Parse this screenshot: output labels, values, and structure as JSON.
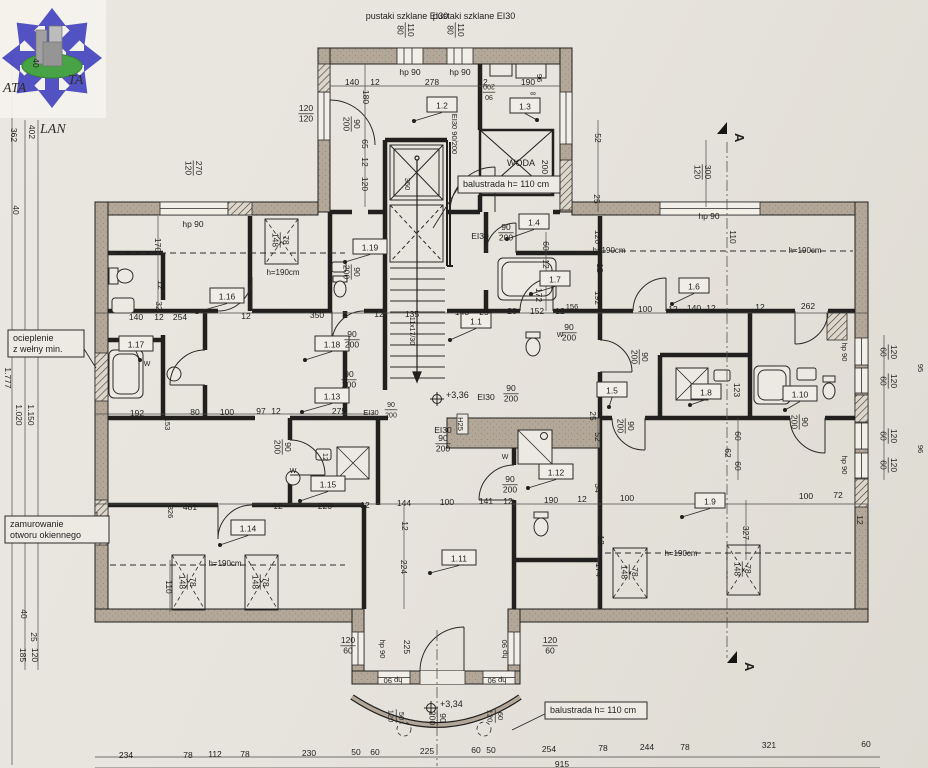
{
  "logo": {
    "ata": "ATA",
    "ta": "TA",
    "lan": "LAN",
    "blue": "#4646c0",
    "green": "#3a9e3a",
    "building": "#9b9b9b"
  },
  "annotations": {
    "glass_blocks_1": "pustaki szklane EI30",
    "glass_blocks_2": "pustaki szklane EI30",
    "water_shaft": "WODA"
  },
  "levels": [
    {
      "t": "+3,36",
      "x": 437,
      "y": 399
    },
    {
      "t": "+3,34",
      "x": 431,
      "y": 708
    }
  ],
  "sections": [
    {
      "label": "A",
      "x": 727,
      "y": 131
    },
    {
      "label": "A",
      "x": 737,
      "y": 660
    }
  ],
  "notes": [
    {
      "lines": [
        "balustrada h= 110 cm"
      ],
      "x": 458,
      "y": 176,
      "w": 102,
      "h": 17,
      "lx": 433,
      "ly": 228
    },
    {
      "lines": [
        "balustrada h= 110 cm"
      ],
      "x": 545,
      "y": 702,
      "w": 102,
      "h": 17,
      "lx": 512,
      "ly": 730
    },
    {
      "lines": [
        "ocieplenie",
        "z wełny min."
      ],
      "x": 8,
      "y": 330,
      "w": 76,
      "h": 27,
      "lx": 96,
      "ly": 368
    },
    {
      "lines": [
        "zamurowanie",
        "otworu okiennego"
      ],
      "x": 5,
      "y": 516,
      "w": 104,
      "h": 27,
      "lx": 97,
      "ly": 512
    }
  ],
  "rooms": [
    {
      "id": "1.1",
      "x": 476,
      "y": 321,
      "lx": 450,
      "ly": 340
    },
    {
      "id": "1.2",
      "x": 442,
      "y": 105,
      "lx": 414,
      "ly": 121
    },
    {
      "id": "1.3",
      "x": 525,
      "y": 106,
      "lx": 537,
      "ly": 120
    },
    {
      "id": "1.4",
      "x": 534,
      "y": 222,
      "lx": 507,
      "ly": 239
    },
    {
      "id": "1.5",
      "x": 612,
      "y": 390,
      "lx": 609,
      "ly": 407
    },
    {
      "id": "1.6",
      "x": 694,
      "y": 286,
      "lx": 672,
      "ly": 304
    },
    {
      "id": "1.7",
      "x": 555,
      "y": 279,
      "lx": 531,
      "ly": 294
    },
    {
      "id": "1.8",
      "x": 706,
      "y": 392,
      "lx": 690,
      "ly": 405
    },
    {
      "id": "1.9",
      "x": 710,
      "y": 501,
      "lx": 682,
      "ly": 517
    },
    {
      "id": "1.10",
      "x": 800,
      "y": 394,
      "lx": 785,
      "ly": 410
    },
    {
      "id": "1.11",
      "x": 459,
      "y": 558,
      "lx": 430,
      "ly": 573
    },
    {
      "id": "1.12",
      "x": 556,
      "y": 472,
      "lx": 528,
      "ly": 488
    },
    {
      "id": "1.13",
      "x": 332,
      "y": 396,
      "lx": 302,
      "ly": 412
    },
    {
      "id": "1.14",
      "x": 248,
      "y": 528,
      "lx": 220,
      "ly": 545
    },
    {
      "id": "1.15",
      "x": 328,
      "y": 484,
      "lx": 300,
      "ly": 501
    },
    {
      "id": "1.16",
      "x": 227,
      "y": 296,
      "lx": 197,
      "ly": 312
    },
    {
      "id": "1.17",
      "x": 136,
      "y": 344,
      "lx": 140,
      "ly": 360
    },
    {
      "id": "1.18",
      "x": 332,
      "y": 344,
      "lx": 305,
      "ly": 360
    },
    {
      "id": "1.19",
      "x": 370,
      "y": 247,
      "lx": 345,
      "ly": 262
    }
  ],
  "labels": [
    {
      "t": "pustaki szklane EI30",
      "x": 407,
      "y": 16,
      "s": 9
    },
    {
      "t": "pustaki szklane EI30",
      "x": 474,
      "y": 16,
      "s": 9
    },
    {
      "t": "110",
      "t2": "80",
      "x": 406,
      "y": 30,
      "r": 90
    },
    {
      "t": "110",
      "t2": "80",
      "x": 456,
      "y": 30,
      "r": 90
    },
    {
      "t": "hp 90",
      "x": 410,
      "y": 72
    },
    {
      "t": "hp 90",
      "x": 460,
      "y": 72
    },
    {
      "t": "140",
      "x": 352,
      "y": 82
    },
    {
      "t": "12",
      "x": 375,
      "y": 82
    },
    {
      "t": "278",
      "x": 432,
      "y": 82
    },
    {
      "t": "12",
      "x": 483,
      "y": 82
    },
    {
      "t": "190",
      "x": 528,
      "y": 82
    },
    {
      "t": "96",
      "x": 540,
      "y": 78,
      "r": 90,
      "s": 7.5
    },
    {
      "t": "∞",
      "x": 533,
      "y": 93,
      "s": 8
    },
    {
      "t": "90",
      "t2": "200",
      "x": 489,
      "y": 93,
      "r": 180,
      "s": 7
    },
    {
      "t": "120",
      "t2": "120",
      "x": 306,
      "y": 113
    },
    {
      "t": "270",
      "t2": "120",
      "x": 194,
      "y": 168,
      "r": 90
    },
    {
      "t": "hp 90",
      "x": 193,
      "y": 224
    },
    {
      "t": "170",
      "x": 158,
      "y": 245,
      "r": 90
    },
    {
      "t": "12",
      "x": 161,
      "y": 285,
      "r": 90
    },
    {
      "t": "32",
      "x": 159,
      "y": 306,
      "r": 90
    },
    {
      "t": "180",
      "x": 366,
      "y": 97,
      "r": 90
    },
    {
      "t": "65",
      "x": 365,
      "y": 144,
      "r": 90
    },
    {
      "t": "12",
      "x": 365,
      "y": 162,
      "r": 90
    },
    {
      "t": "120",
      "x": 365,
      "y": 184,
      "r": 90
    },
    {
      "t": "hp 90",
      "x": 709,
      "y": 216
    },
    {
      "t": "300",
      "t2": "120",
      "x": 703,
      "y": 172,
      "r": 90
    },
    {
      "t": "110",
      "x": 733,
      "y": 237,
      "r": 90
    },
    {
      "t": "h=190cm",
      "x": 283,
      "y": 272,
      "s": 8
    },
    {
      "t": "h=190cm",
      "x": 609,
      "y": 250,
      "s": 8
    },
    {
      "t": "h=190cm",
      "x": 805,
      "y": 250,
      "s": 8
    },
    {
      "t": "h=190cm",
      "x": 225,
      "y": 563,
      "s": 8
    },
    {
      "t": "h=190cm",
      "x": 681,
      "y": 553,
      "s": 8
    },
    {
      "t": "140",
      "x": 136,
      "y": 317
    },
    {
      "t": "12",
      "x": 159,
      "y": 317
    },
    {
      "t": "254",
      "x": 180,
      "y": 317
    },
    {
      "t": "12",
      "x": 246,
      "y": 316
    },
    {
      "t": "350",
      "x": 317,
      "y": 315
    },
    {
      "t": "12",
      "x": 379,
      "y": 314
    },
    {
      "t": "135",
      "x": 412,
      "y": 314
    },
    {
      "t": "143",
      "x": 462,
      "y": 312
    },
    {
      "t": "25",
      "x": 484,
      "y": 312
    },
    {
      "t": "20",
      "x": 512,
      "y": 311
    },
    {
      "t": "152",
      "x": 537,
      "y": 311
    },
    {
      "t": "12",
      "x": 560,
      "y": 311
    },
    {
      "t": "156",
      "x": 572,
      "y": 306,
      "s": 7.5
    },
    {
      "t": "192",
      "x": 598,
      "y": 298,
      "r": 90
    },
    {
      "t": "100",
      "x": 645,
      "y": 309
    },
    {
      "t": "12",
      "x": 673,
      "y": 309
    },
    {
      "t": "140",
      "x": 694,
      "y": 308
    },
    {
      "t": "12",
      "x": 711,
      "y": 308
    },
    {
      "t": "12",
      "x": 760,
      "y": 307
    },
    {
      "t": "262",
      "x": 808,
      "y": 306
    },
    {
      "t": "120",
      "x": 598,
      "y": 237,
      "r": 90
    },
    {
      "t": "12",
      "x": 600,
      "y": 268,
      "r": 90
    },
    {
      "t": "60",
      "x": 546,
      "y": 246,
      "r": 90
    },
    {
      "t": "12",
      "x": 546,
      "y": 264,
      "r": 90
    },
    {
      "t": "172",
      "x": 539,
      "y": 295,
      "r": 90
    },
    {
      "t": "52",
      "x": 598,
      "y": 138,
      "r": 90
    },
    {
      "t": "200",
      "x": 545,
      "y": 167,
      "r": 90
    },
    {
      "t": "25",
      "x": 597,
      "y": 199,
      "r": 90
    },
    {
      "t": "WODA",
      "x": 521,
      "y": 163,
      "s": 9
    },
    {
      "t": "192",
      "x": 137,
      "y": 413
    },
    {
      "t": "80",
      "x": 195,
      "y": 412
    },
    {
      "t": "100",
      "x": 227,
      "y": 412
    },
    {
      "t": "97",
      "x": 261,
      "y": 411
    },
    {
      "t": "12",
      "x": 276,
      "y": 411
    },
    {
      "t": "275",
      "x": 339,
      "y": 411
    },
    {
      "t": "153",
      "x": 168,
      "y": 424,
      "r": 90,
      "s": 7.5
    },
    {
      "t": "12",
      "x": 326,
      "y": 457,
      "r": 90,
      "s": 7.5
    },
    {
      "t": "481",
      "x": 190,
      "y": 507
    },
    {
      "t": "12",
      "x": 278,
      "y": 506
    },
    {
      "t": "220",
      "x": 325,
      "y": 506
    },
    {
      "t": "12",
      "x": 365,
      "y": 505
    },
    {
      "t": "144",
      "x": 404,
      "y": 503
    },
    {
      "t": "100",
      "x": 447,
      "y": 502
    },
    {
      "t": "141",
      "x": 486,
      "y": 501
    },
    {
      "t": "12",
      "x": 508,
      "y": 501
    },
    {
      "t": "190",
      "x": 551,
      "y": 500
    },
    {
      "t": "12",
      "x": 582,
      "y": 499
    },
    {
      "t": "100",
      "x": 627,
      "y": 498
    },
    {
      "t": "100",
      "x": 806,
      "y": 496
    },
    {
      "t": "72",
      "x": 838,
      "y": 495
    },
    {
      "t": "326",
      "x": 171,
      "y": 512,
      "r": 90,
      "s": 7.5
    },
    {
      "t": "110",
      "x": 169,
      "y": 587,
      "r": 90
    },
    {
      "t": "224",
      "x": 404,
      "y": 567,
      "r": 90
    },
    {
      "t": "12",
      "x": 405,
      "y": 526,
      "r": 90
    },
    {
      "t": "52",
      "x": 598,
      "y": 437,
      "r": 90
    },
    {
      "t": "34",
      "x": 598,
      "y": 488,
      "r": 90
    },
    {
      "t": "12",
      "x": 601,
      "y": 540,
      "r": 90
    },
    {
      "t": "174",
      "x": 599,
      "y": 570,
      "r": 90
    },
    {
      "t": "25",
      "x": 593,
      "y": 416,
      "r": 90
    },
    {
      "t": "60",
      "x": 738,
      "y": 436,
      "r": 90
    },
    {
      "t": "62",
      "x": 728,
      "y": 453,
      "r": 90
    },
    {
      "t": "60",
      "x": 738,
      "y": 466,
      "r": 90
    },
    {
      "t": "327",
      "x": 746,
      "y": 533,
      "r": 90
    },
    {
      "t": "123",
      "x": 737,
      "y": 390,
      "r": 90
    },
    {
      "t": "12",
      "x": 860,
      "y": 520,
      "r": 90
    },
    {
      "t": "120",
      "t2": "60",
      "x": 889,
      "y": 352,
      "r": 90
    },
    {
      "t": "120",
      "t2": "60",
      "x": 889,
      "y": 381,
      "r": 90
    },
    {
      "t": "120",
      "t2": "60",
      "x": 889,
      "y": 436,
      "r": 90
    },
    {
      "t": "120",
      "t2": "60",
      "x": 889,
      "y": 465,
      "r": 90
    },
    {
      "t": "hp 90",
      "x": 845,
      "y": 352,
      "r": 90,
      "s": 7.5
    },
    {
      "t": "hp 90",
      "x": 845,
      "y": 465,
      "r": 90,
      "s": 7.5
    },
    {
      "t": "95",
      "x": 921,
      "y": 368,
      "r": 90,
      "s": 7.5,
      "c": "#96928a"
    },
    {
      "t": "96",
      "x": 921,
      "y": 449,
      "r": 90,
      "s": 7.5,
      "c": "#96928a"
    },
    {
      "t": "EI30 90/200",
      "x": 455,
      "y": 134,
      "r": 90,
      "s": 7.5
    },
    {
      "t": "EI30",
      "x": 480,
      "y": 236
    },
    {
      "t": "90",
      "t2": "200",
      "x": 506,
      "y": 232
    },
    {
      "t": "EI30",
      "x": 486,
      "y": 397
    },
    {
      "t": "90",
      "t2": "200",
      "x": 511,
      "y": 393
    },
    {
      "t": "EI30",
      "x": 443,
      "y": 430
    },
    {
      "t": "90",
      "t2": "200",
      "x": 443,
      "y": 443
    },
    {
      "t": "EI30",
      "x": 371,
      "y": 412,
      "s": 7.5
    },
    {
      "t": "90",
      "t2": "200",
      "x": 391,
      "y": 409,
      "s": 7
    },
    {
      "t": "90",
      "t2": "200",
      "x": 352,
      "y": 272,
      "r": 90
    },
    {
      "t": "90",
      "t2": "200",
      "x": 352,
      "y": 124,
      "r": 90
    },
    {
      "t": "90",
      "t2": "200",
      "x": 352,
      "y": 339
    },
    {
      "t": "90",
      "t2": "200",
      "x": 349,
      "y": 379
    },
    {
      "t": "90",
      "t2": "200",
      "x": 283,
      "y": 447,
      "r": 90
    },
    {
      "t": "90",
      "t2": "200",
      "x": 510,
      "y": 484
    },
    {
      "t": "90",
      "t2": "200",
      "x": 438,
      "y": 718,
      "r": 90
    },
    {
      "t": "90",
      "t2": "200",
      "x": 800,
      "y": 422,
      "r": 90
    },
    {
      "t": "90",
      "t2": "200",
      "x": 569,
      "y": 332
    },
    {
      "t": "90",
      "t2": "200",
      "x": 640,
      "y": 357,
      "r": 90
    },
    {
      "t": "90",
      "t2": "200",
      "x": 626,
      "y": 426,
      "r": 90
    },
    {
      "t": "H25",
      "x": 461,
      "y": 424,
      "r": 90,
      "b": true,
      "s": 7.5
    },
    {
      "t": "11x17/30",
      "x": 413,
      "y": 331,
      "r": 90,
      "s": 7
    },
    {
      "t": "350",
      "x": 408,
      "y": 184,
      "r": 90,
      "s": 7.5
    },
    {
      "t": "120",
      "t2": "60",
      "x": 348,
      "y": 645
    },
    {
      "t": "120",
      "t2": "60",
      "x": 550,
      "y": 645
    },
    {
      "t": "hp 90",
      "x": 383,
      "y": 649,
      "r": 90,
      "s": 7.5
    },
    {
      "t": "hp 90",
      "x": 504,
      "y": 649,
      "r": -90,
      "s": 7.5
    },
    {
      "t": "225",
      "x": 407,
      "y": 647,
      "r": 90
    },
    {
      "t": "hp 90",
      "x": 393,
      "y": 681,
      "r": 180,
      "s": 7.5
    },
    {
      "t": "hp 90",
      "x": 497,
      "y": 681,
      "r": 180,
      "s": 7.5
    },
    {
      "t": "50",
      "t2": "120",
      "x": 397,
      "y": 716,
      "r": 90,
      "s": 7.5
    },
    {
      "t": "60",
      "t2": "120",
      "x": 496,
      "y": 716,
      "r": 90,
      "s": 7.5
    },
    {
      "t": "234",
      "x": 126,
      "y": 755
    },
    {
      "t": "78",
      "x": 188,
      "y": 755
    },
    {
      "t": "112",
      "x": 215,
      "y": 754
    },
    {
      "t": "78",
      "x": 245,
      "y": 754
    },
    {
      "t": "230",
      "x": 309,
      "y": 753
    },
    {
      "t": "50",
      "x": 356,
      "y": 752
    },
    {
      "t": "60",
      "x": 375,
      "y": 752
    },
    {
      "t": "225",
      "x": 427,
      "y": 751
    },
    {
      "t": "60",
      "x": 476,
      "y": 750
    },
    {
      "t": "50",
      "x": 491,
      "y": 750
    },
    {
      "t": "254",
      "x": 549,
      "y": 749
    },
    {
      "t": "78",
      "x": 603,
      "y": 748
    },
    {
      "t": "244",
      "x": 647,
      "y": 747
    },
    {
      "t": "78",
      "x": 685,
      "y": 747
    },
    {
      "t": "321",
      "x": 769,
      "y": 745
    },
    {
      "t": "60",
      "x": 866,
      "y": 744
    },
    {
      "t": "915",
      "x": 562,
      "y": 764
    },
    {
      "t": "40",
      "x": 36,
      "y": 63,
      "r": 90
    },
    {
      "t": "362",
      "x": 14,
      "y": 135,
      "r": 90
    },
    {
      "t": "402",
      "x": 32,
      "y": 132,
      "r": 90
    },
    {
      "t": "40",
      "x": 16,
      "y": 210,
      "r": 90
    },
    {
      "t": "1.777",
      "x": 8,
      "y": 378,
      "r": 90
    },
    {
      "t": "1.020",
      "x": 19,
      "y": 415,
      "r": 90
    },
    {
      "t": "1.150",
      "x": 31,
      "y": 415,
      "r": 90
    },
    {
      "t": "40",
      "x": 24,
      "y": 614,
      "r": 90
    },
    {
      "t": "25",
      "x": 34,
      "y": 637,
      "r": 90
    },
    {
      "t": "185",
      "x": 23,
      "y": 655,
      "r": 90
    },
    {
      "t": "120",
      "x": 35,
      "y": 655,
      "r": 90
    },
    {
      "t": "78",
      "t2": "148",
      "x": 281,
      "y": 240,
      "r": 90
    },
    {
      "t": "78",
      "t2": "148",
      "x": 188,
      "y": 582,
      "r": 90
    },
    {
      "t": "78",
      "t2": "148",
      "x": 261,
      "y": 582,
      "r": 90
    },
    {
      "t": "78",
      "t2": "148",
      "x": 630,
      "y": 572,
      "r": 90
    },
    {
      "t": "78",
      "t2": "148",
      "x": 743,
      "y": 569,
      "r": 90
    },
    {
      "t": "W",
      "x": 147,
      "y": 363,
      "s": 7
    },
    {
      "t": "W",
      "x": 505,
      "y": 456,
      "s": 7
    },
    {
      "t": "W",
      "x": 560,
      "y": 334,
      "s": 7
    },
    {
      "t": "W",
      "x": 293,
      "y": 470,
      "s": 7
    }
  ]
}
